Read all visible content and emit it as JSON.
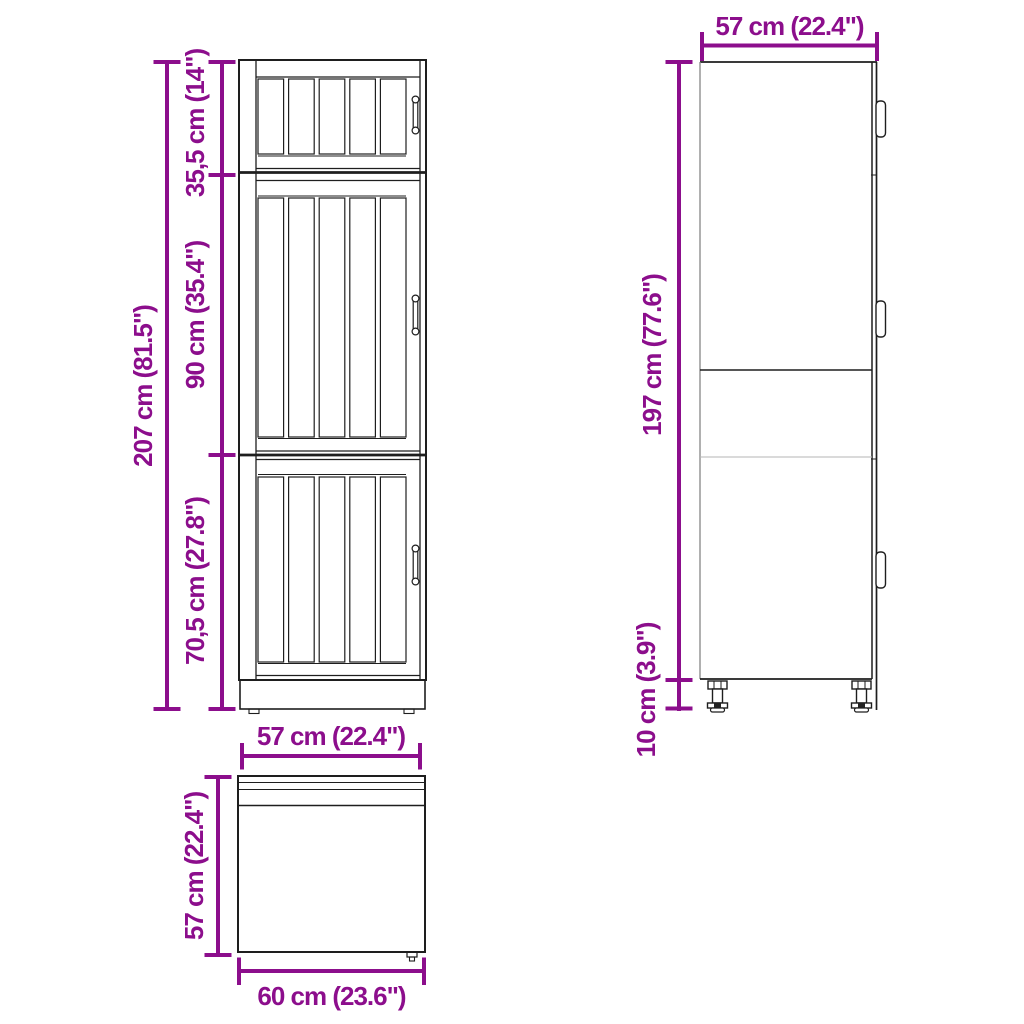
{
  "diagram": {
    "type": "furniture-dimension-diagram",
    "object": "kitchen tall cabinet line drawing, three views (front, side, top)",
    "colors": {
      "dimension": "#8C0E8C",
      "outline": "#1e1e1e",
      "background": "#ffffff"
    },
    "front_view": {
      "total_height": "207 cm (81.5\")",
      "section_top": "35,5 cm (14\")",
      "section_middle": "90 cm (35.4\")",
      "section_bottom": "70,5 cm (27.8\")"
    },
    "side_view": {
      "depth": "57 cm (22.4\")",
      "body_height": "197 cm (77.6\")",
      "leg_height": "10 cm (3.9\")"
    },
    "top_view": {
      "width": "57 cm (22.4\")",
      "depth": "57 cm (22.4\")",
      "width_bottom": "60 cm (23.6\")"
    }
  }
}
